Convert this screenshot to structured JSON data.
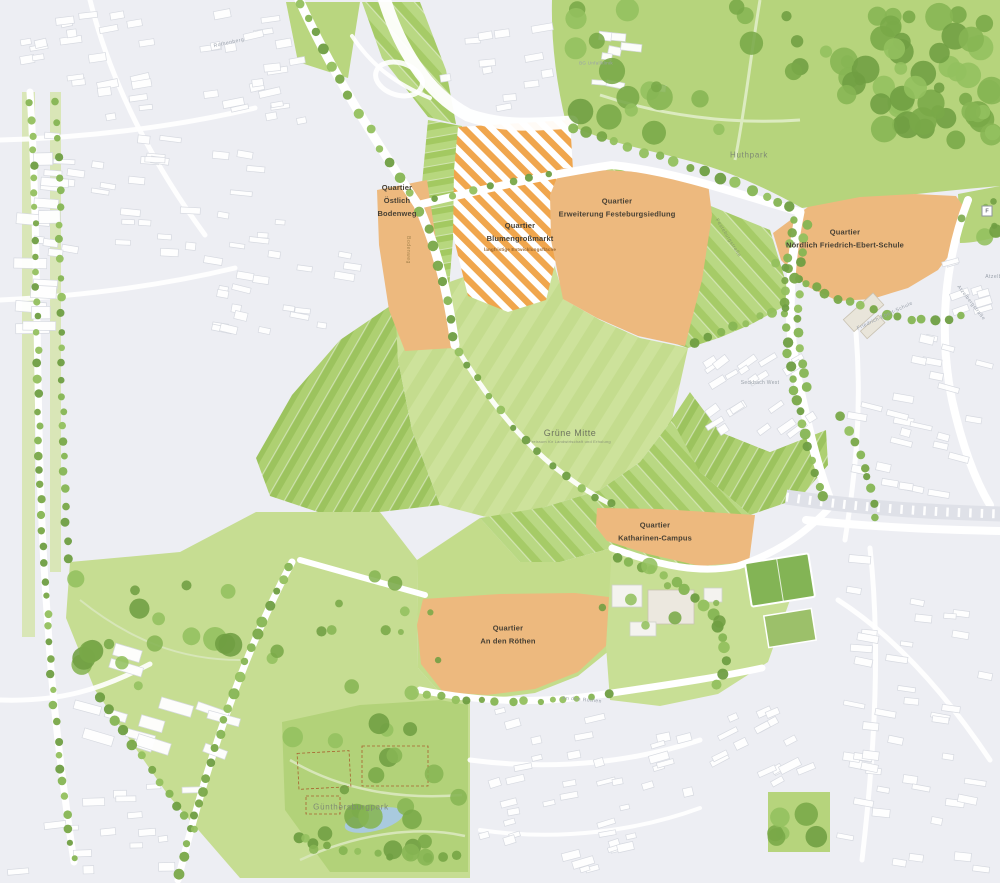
{
  "map": {
    "quarters": [
      {
        "name": "Östlich Bodenweg",
        "label": "Quartier\nÖstlich\nBodenweg"
      },
      {
        "name": "Blumengroßmarkt",
        "label": "Quartier\nBlumengroßmarkt",
        "sublabel": "langfristige Entwicklungsfläche"
      },
      {
        "name": "Erweiterung Festeburgsiedlung",
        "label": "Quartier\nErweiterung Festeburgsiedlung"
      },
      {
        "name": "Nördlich Friedrich-Ebert-Schule",
        "label": "Quartier\nNördlich Friedrich-Ebert-Schule"
      },
      {
        "name": "Katharinen-Campus",
        "label": "Quartier\nKatharinen-Campus"
      },
      {
        "name": "An den Röthen",
        "label": "Quartier\nAn den Röthen"
      }
    ],
    "areas": {
      "gruene_mitte": {
        "label": "Grüne Mitte",
        "sublabel": "Freiraum für Landwirtschaft und Erholung"
      },
      "huthpark": {
        "label": "Huthpark"
      },
      "guenthersburgpark": {
        "label": "Günthersburgpark"
      },
      "seckbach_west": {
        "label": "Seckbach West"
      },
      "bg_unfallklinik": {
        "label": "BG Unfallklinik"
      }
    },
    "streets": {
      "rothenberg": "Rothenberg",
      "bodenweg": "Bodenweg",
      "festeburgstrasse": "Festeburgstraße",
      "friedrich_ebert_schule": "Friedrich-Ebert-Schule",
      "atzelbergstrasse": "Atzelbergstraße",
      "atzelberg": "Atzelberg",
      "an_den_roethen": "An den Röthen"
    },
    "symbols": {
      "f_badge": "F"
    },
    "colors": {
      "background": "#edeef3",
      "quarter_orange": "#edb97e",
      "hatch_orange": "#f0a64d",
      "field_green": "#a8cc66",
      "meadow_green": "#cde29b",
      "park_green": "#b6d47c",
      "tree_green": "#7fae4f",
      "water_blue": "#a9cade",
      "building_white": "#ffffff",
      "label_dark": "#463f33"
    }
  }
}
